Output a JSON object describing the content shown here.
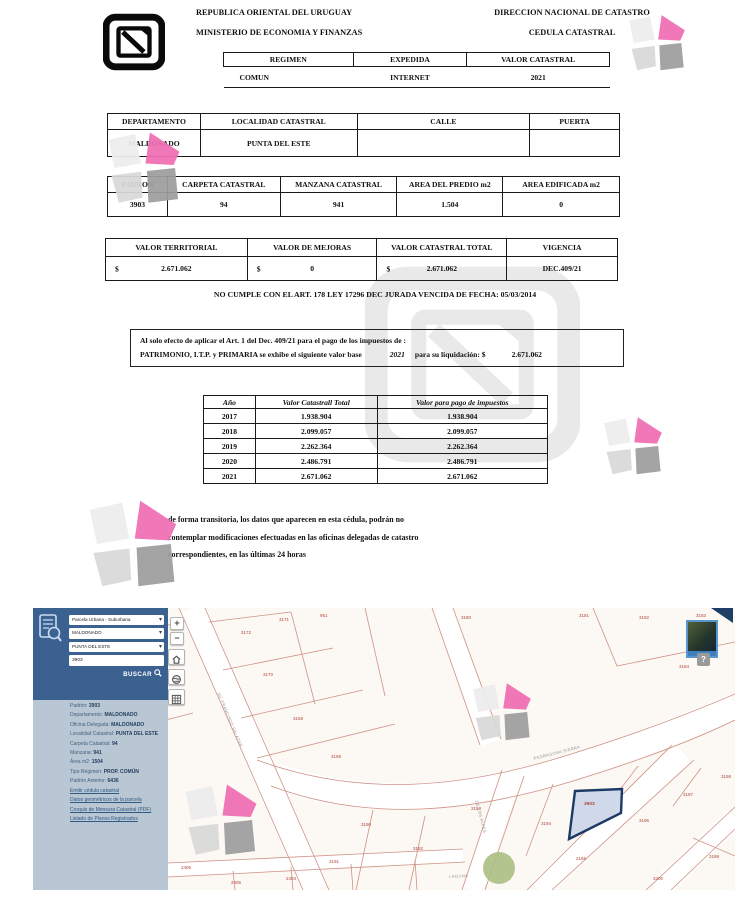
{
  "document": {
    "header": {
      "left_line1": "REPUBLICA ORIENTAL DEL URUGUAY",
      "left_line2": "MINISTERIO DE ECONOMIA Y FINANZAS",
      "right_line1": "DIRECCION NACIONAL DE CATASTRO",
      "right_line2": "CEDULA CATASTRAL"
    },
    "regimen_table": {
      "headers": [
        "REGIMEN",
        "EXPEDIDA",
        "VALOR CATASTRAL"
      ],
      "values": [
        "COMUN",
        "INTERNET",
        "2021"
      ]
    },
    "location_table": {
      "headers": [
        "DEPARTAMENTO",
        "LOCALIDAD CATASTRAL",
        "CALLE",
        "PUERTA"
      ],
      "values": [
        "MALDONADO",
        "PUNTA DEL ESTE",
        "",
        ""
      ]
    },
    "padron_table": {
      "headers": [
        "PADRON",
        "CARPETA CATASTRAL",
        "MANZANA CATASTRAL",
        "AREA DEL PREDIO m2",
        "AREA EDIFICADA m2"
      ],
      "values": [
        "3903",
        "94",
        "941",
        "1.504",
        "0"
      ]
    },
    "valores_table": {
      "headers": [
        "VALOR TERRITORIAL",
        "VALOR DE MEJORAS",
        "VALOR CATASTRAL TOTAL",
        "VIGENCIA"
      ],
      "currency_symbol": "$",
      "values": [
        "2.671.062",
        "0",
        "2.671.062"
      ],
      "vigencia": "DEC.409/21"
    },
    "notice": "NO CUMPLE CON EL ART. 178 LEY 17296 DEC JURADA VENCIDA DE FECHA: 05/03/2014",
    "tax_box": {
      "line1": "Al solo efecto de aplicar el Art. 1 del Dec. 409/21 para el pago de los impuestos de :",
      "line2_part1": "PATRIMONIO, I.T.P.  y PRIMARIA se exhibe el siguiente valor base",
      "line2_year": "2021",
      "line2_part2": "para su liquidación: $",
      "line2_value": "2.671.062"
    },
    "years_table": {
      "headers": [
        "Año",
        "Valor Catastrall Total",
        "Valor para pago de impuestos"
      ],
      "rows": [
        [
          "2017",
          "1.938.904",
          "1.938.904"
        ],
        [
          "2018",
          "2.099.057",
          "2.099.057"
        ],
        [
          "2019",
          "2.262.364",
          "2.262.364"
        ],
        [
          "2020",
          "2.486.791",
          "2.486.791"
        ],
        [
          "2021",
          "2.671.062",
          "2.671.062"
        ]
      ]
    },
    "footer_lines": [
      "de forma transitoria, los datos que aparecen en esta cédula, podrán no",
      "contemplar modificaciones efectuadas en las oficinas delegadas de catastro",
      "correspondientes, en las últimas 24 horas"
    ]
  },
  "map": {
    "sidebar": {
      "selects": [
        "Parcela Urbana - Suburbana",
        "MALDONADO",
        "PUNTA DEL ESTE"
      ],
      "search_value": "3903",
      "buscar_label": "BUSCAR",
      "info": [
        {
          "label": "Padrón:",
          "value": "3903"
        },
        {
          "label": "Departamento:",
          "value": "MALDONADO"
        },
        {
          "label": "Oficina Delegada:",
          "value": "MALDONADO"
        },
        {
          "label": "Localidad Catastral:",
          "value": "PUNTA DEL ESTE"
        },
        {
          "label": "Carpeta Catastral:",
          "value": "94"
        },
        {
          "label": "Manzana:",
          "value": "941"
        },
        {
          "label": "Área m2:",
          "value": "1504"
        },
        {
          "label": "Tipo Régimen:",
          "value": "PROP. COMÚN"
        },
        {
          "label": "Padrón Anterior:",
          "value": "6436"
        }
      ],
      "links": [
        "Emitir cédula catastral",
        "Datos geométricos de la parcela",
        "Croquis de Mensura Catastral (PDF)",
        "Listado de Planos Registrados"
      ]
    },
    "controls": {
      "zoom_in": "+",
      "zoom_out": "−",
      "help": "?"
    },
    "selected_parcel_label": "3903",
    "parcel_labels": [
      {
        "x": 26,
        "y": 26,
        "t": "3174"
      },
      {
        "x": 104,
        "y": 14,
        "t": "3163"
      },
      {
        "x": 46,
        "y": 74,
        "t": "3162"
      },
      {
        "x": 14,
        "y": 116,
        "t": "3161"
      },
      {
        "x": 96,
        "y": 126,
        "t": "1154"
      },
      {
        "x": 28,
        "y": 170,
        "t": "3159"
      },
      {
        "x": 84,
        "y": 203,
        "t": "3158"
      },
      {
        "x": 38,
        "y": 243,
        "t": "6416"
      },
      {
        "x": 90,
        "y": 261,
        "t": "2407"
      },
      {
        "x": 148,
        "y": 257,
        "t": "2406"
      },
      {
        "x": 208,
        "y": 22,
        "t": "3172"
      },
      {
        "x": 246,
        "y": 9,
        "t": "3171"
      },
      {
        "x": 287,
        "y": 5,
        "t": "951"
      },
      {
        "x": 230,
        "y": 64,
        "t": "3170"
      },
      {
        "x": 260,
        "y": 108,
        "t": "3169"
      },
      {
        "x": 298,
        "y": 146,
        "t": "3168"
      },
      {
        "x": 428,
        "y": 7,
        "t": "3180"
      },
      {
        "x": 485,
        "y": 88,
        "t": "263"
      },
      {
        "x": 546,
        "y": 5,
        "t": "3181"
      },
      {
        "x": 606,
        "y": 7,
        "t": "3182"
      },
      {
        "x": 663,
        "y": 5,
        "t": "3183"
      },
      {
        "x": 646,
        "y": 56,
        "t": "3184"
      },
      {
        "x": 328,
        "y": 214,
        "t": "3190"
      },
      {
        "x": 296,
        "y": 251,
        "t": "3191"
      },
      {
        "x": 380,
        "y": 238,
        "t": "3192"
      },
      {
        "x": 438,
        "y": 198,
        "t": "3193"
      },
      {
        "x": 508,
        "y": 213,
        "t": "3194"
      },
      {
        "x": 543,
        "y": 248,
        "t": "2168"
      },
      {
        "x": 606,
        "y": 210,
        "t": "3196"
      },
      {
        "x": 650,
        "y": 184,
        "t": "3197"
      },
      {
        "x": 688,
        "y": 166,
        "t": "3198"
      },
      {
        "x": 676,
        "y": 246,
        "t": "3199"
      },
      {
        "x": 620,
        "y": 268,
        "t": "3200"
      },
      {
        "x": 198,
        "y": 272,
        "t": "2405"
      },
      {
        "x": 253,
        "y": 268,
        "t": "2404"
      }
    ],
    "street_labels": [
      {
        "x": 188,
        "y": 84,
        "r": 67,
        "t": "AV. FRANCISCO SALAZAR"
      },
      {
        "x": 500,
        "y": 148,
        "r": -14,
        "t": "PEDRAGOSA SIERRA"
      },
      {
        "x": 446,
        "y": 192,
        "r": 75,
        "t": "DE LOS ALPES"
      },
      {
        "x": 416,
        "y": 266,
        "r": -3,
        "t": "LAGUNA"
      }
    ]
  },
  "colors": {
    "sidebar_dark": "#3b6191",
    "sidebar_light": "#b9c6d4",
    "map_bg": "#fcf9f4",
    "parcel_line": "#cf9186",
    "parcel_number": "#b0453c",
    "selected_border": "#1c3a66",
    "selected_fill": "#cfd9ea",
    "pink": "#ef6eb3",
    "green_circle": "#a9bd80",
    "link": "#2e5a86"
  }
}
